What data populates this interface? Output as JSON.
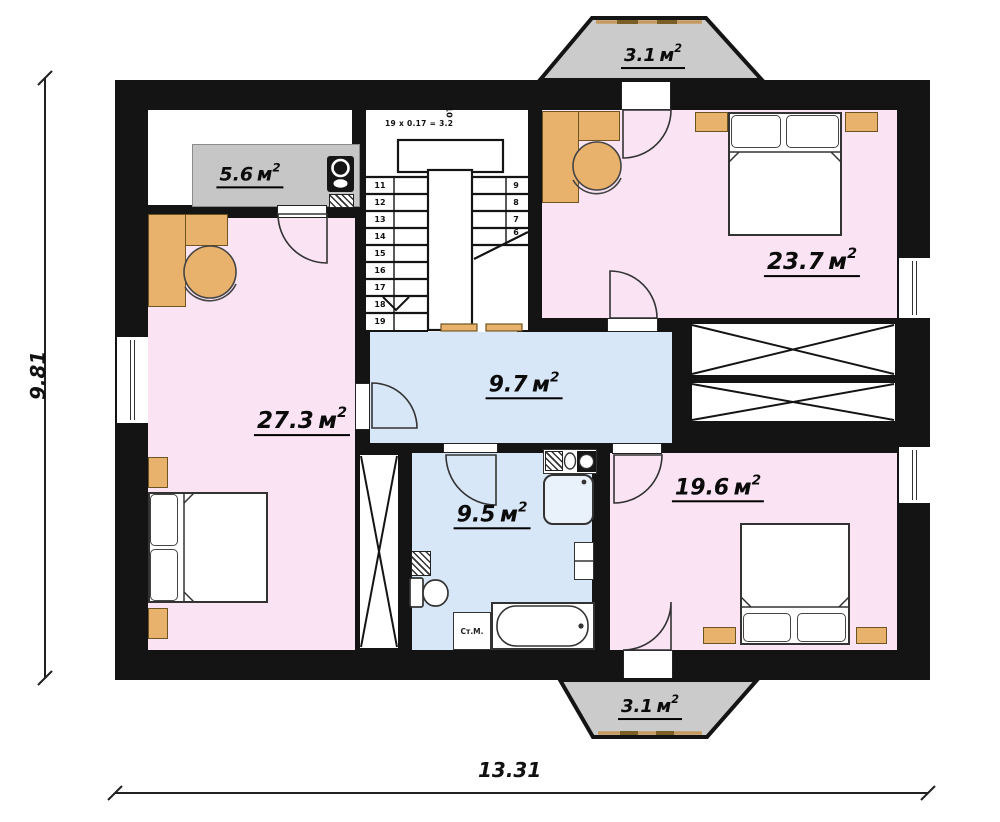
{
  "dimensions": {
    "horizontal": "13.31",
    "vertical": "9.81"
  },
  "units": {
    "m": "м",
    "sup": "2"
  },
  "areas": {
    "kitchen": "5.6",
    "bedroom_top_right": "23.7",
    "bedroom_left": "27.3",
    "hall": "9.7",
    "bathroom": "9.5",
    "bedroom_bottom_right": "19.6",
    "balcony_top": "3.1",
    "balcony_bottom": "3.1"
  },
  "stairs": {
    "formula": "19 x 0.17 = 3.2",
    "top_step": "10",
    "left_steps": [
      "11",
      "12",
      "13",
      "14",
      "15",
      "16",
      "17",
      "18",
      "19"
    ],
    "right_steps": [
      "9",
      "8",
      "7",
      "6"
    ]
  },
  "appliances": {
    "washing_machine": "Ст.М."
  },
  "colors": {
    "wall": "#141414",
    "room_pink": "#fae4f4",
    "room_blue": "#d8e7f8",
    "balcony_gray": "#cbcbcb",
    "furniture_tan": "#e8b26c",
    "counter_gray": "#c6c6c6"
  }
}
